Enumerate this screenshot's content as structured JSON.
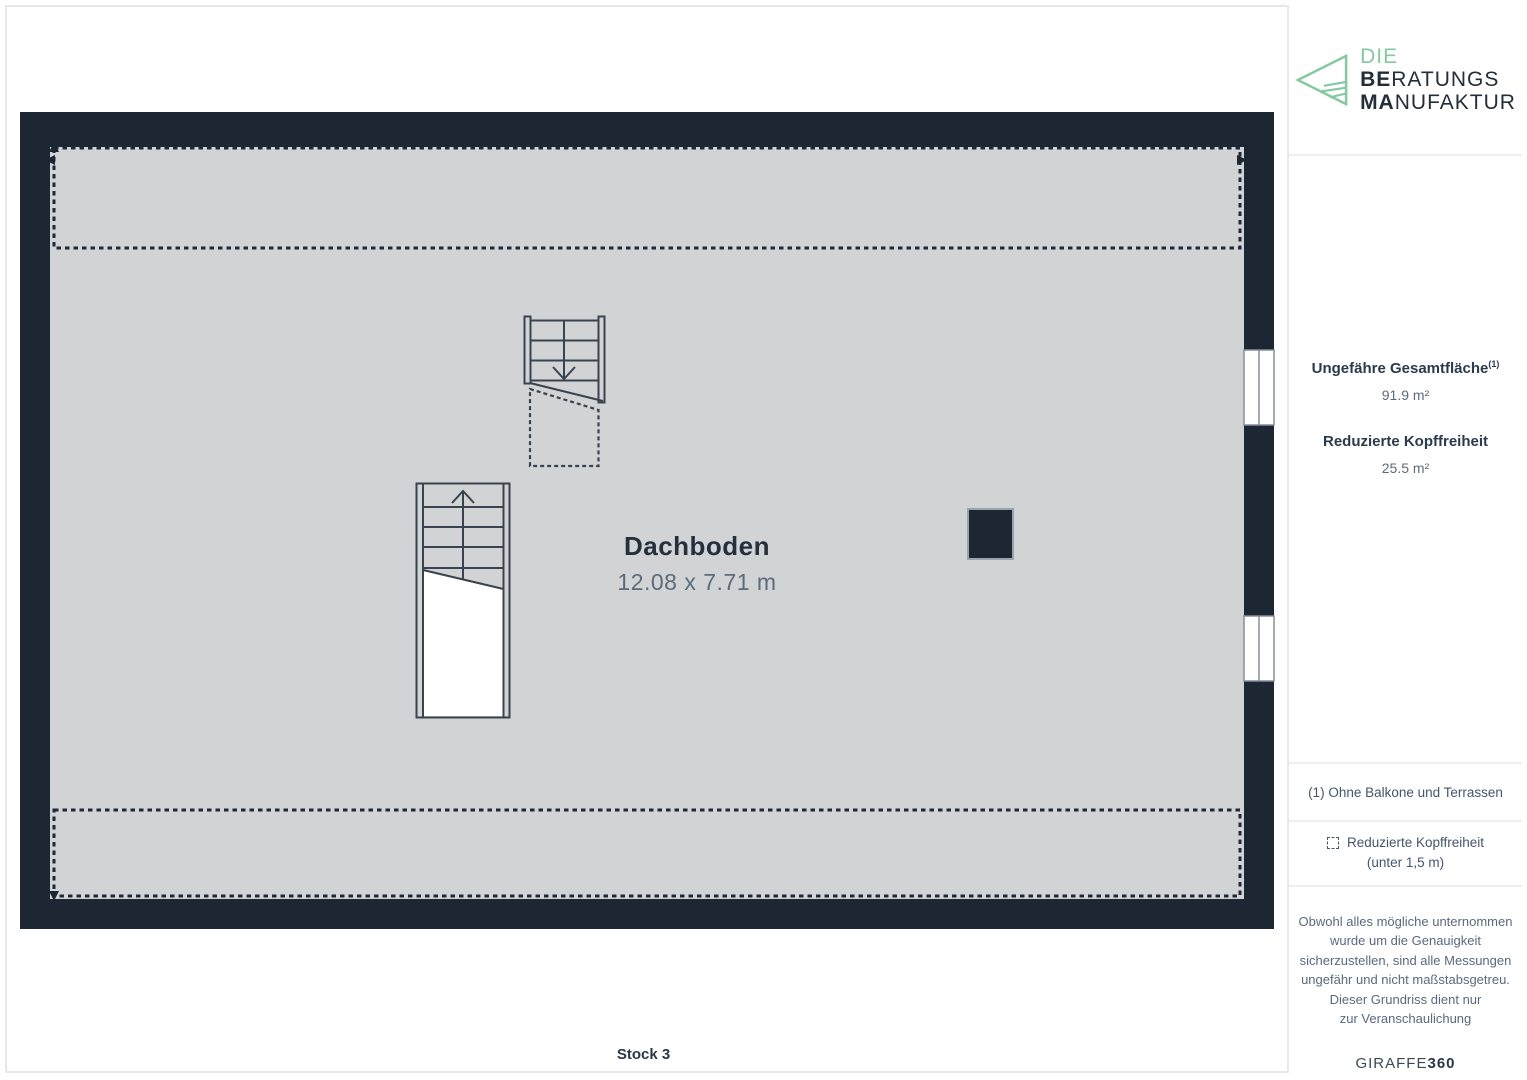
{
  "logo": {
    "line1": "DIE",
    "line2_bold": "BE",
    "line2_rest": "RATUNGS",
    "line3_bold": "MA",
    "line3_rest": "NUFAKTUR"
  },
  "floorplan": {
    "room_name": "Dachboden",
    "room_dimensions": "12.08 x 7.71 m",
    "floor_label": "Stock 3"
  },
  "sidebar": {
    "total_area_label": "Ungefähre Gesamtfläche",
    "total_area_sup": "(1)",
    "total_area_value": "91.9 m²",
    "reduced_label": "Reduzierte Kopffreiheit",
    "reduced_value": "25.5 m²",
    "footnote": "(1) Ohne Balkone und Terrassen",
    "legend_line1": "Reduzierte Kopffreiheit",
    "legend_line2": "(unter 1,5 m)",
    "disclaimer_lines": [
      "Obwohl alles mögliche unternommen",
      "wurde um die Genauigkeit",
      "sicherzustellen, sind alle Messungen",
      "ungefähr und nicht maßstabsgetreu.",
      "Dieser Grundriss dient nur",
      "zur Veranschaulichung"
    ],
    "brand_normal": "GIRAFFE",
    "brand_bold": "360"
  },
  "colors": {
    "wall_navy": "#1d2734",
    "floor_gray": "#d2d3d4",
    "logo_green": "#85c8a2",
    "text_dark": "#25303d",
    "text_muted": "#5c6b7a",
    "divider": "#e6e8ea"
  }
}
